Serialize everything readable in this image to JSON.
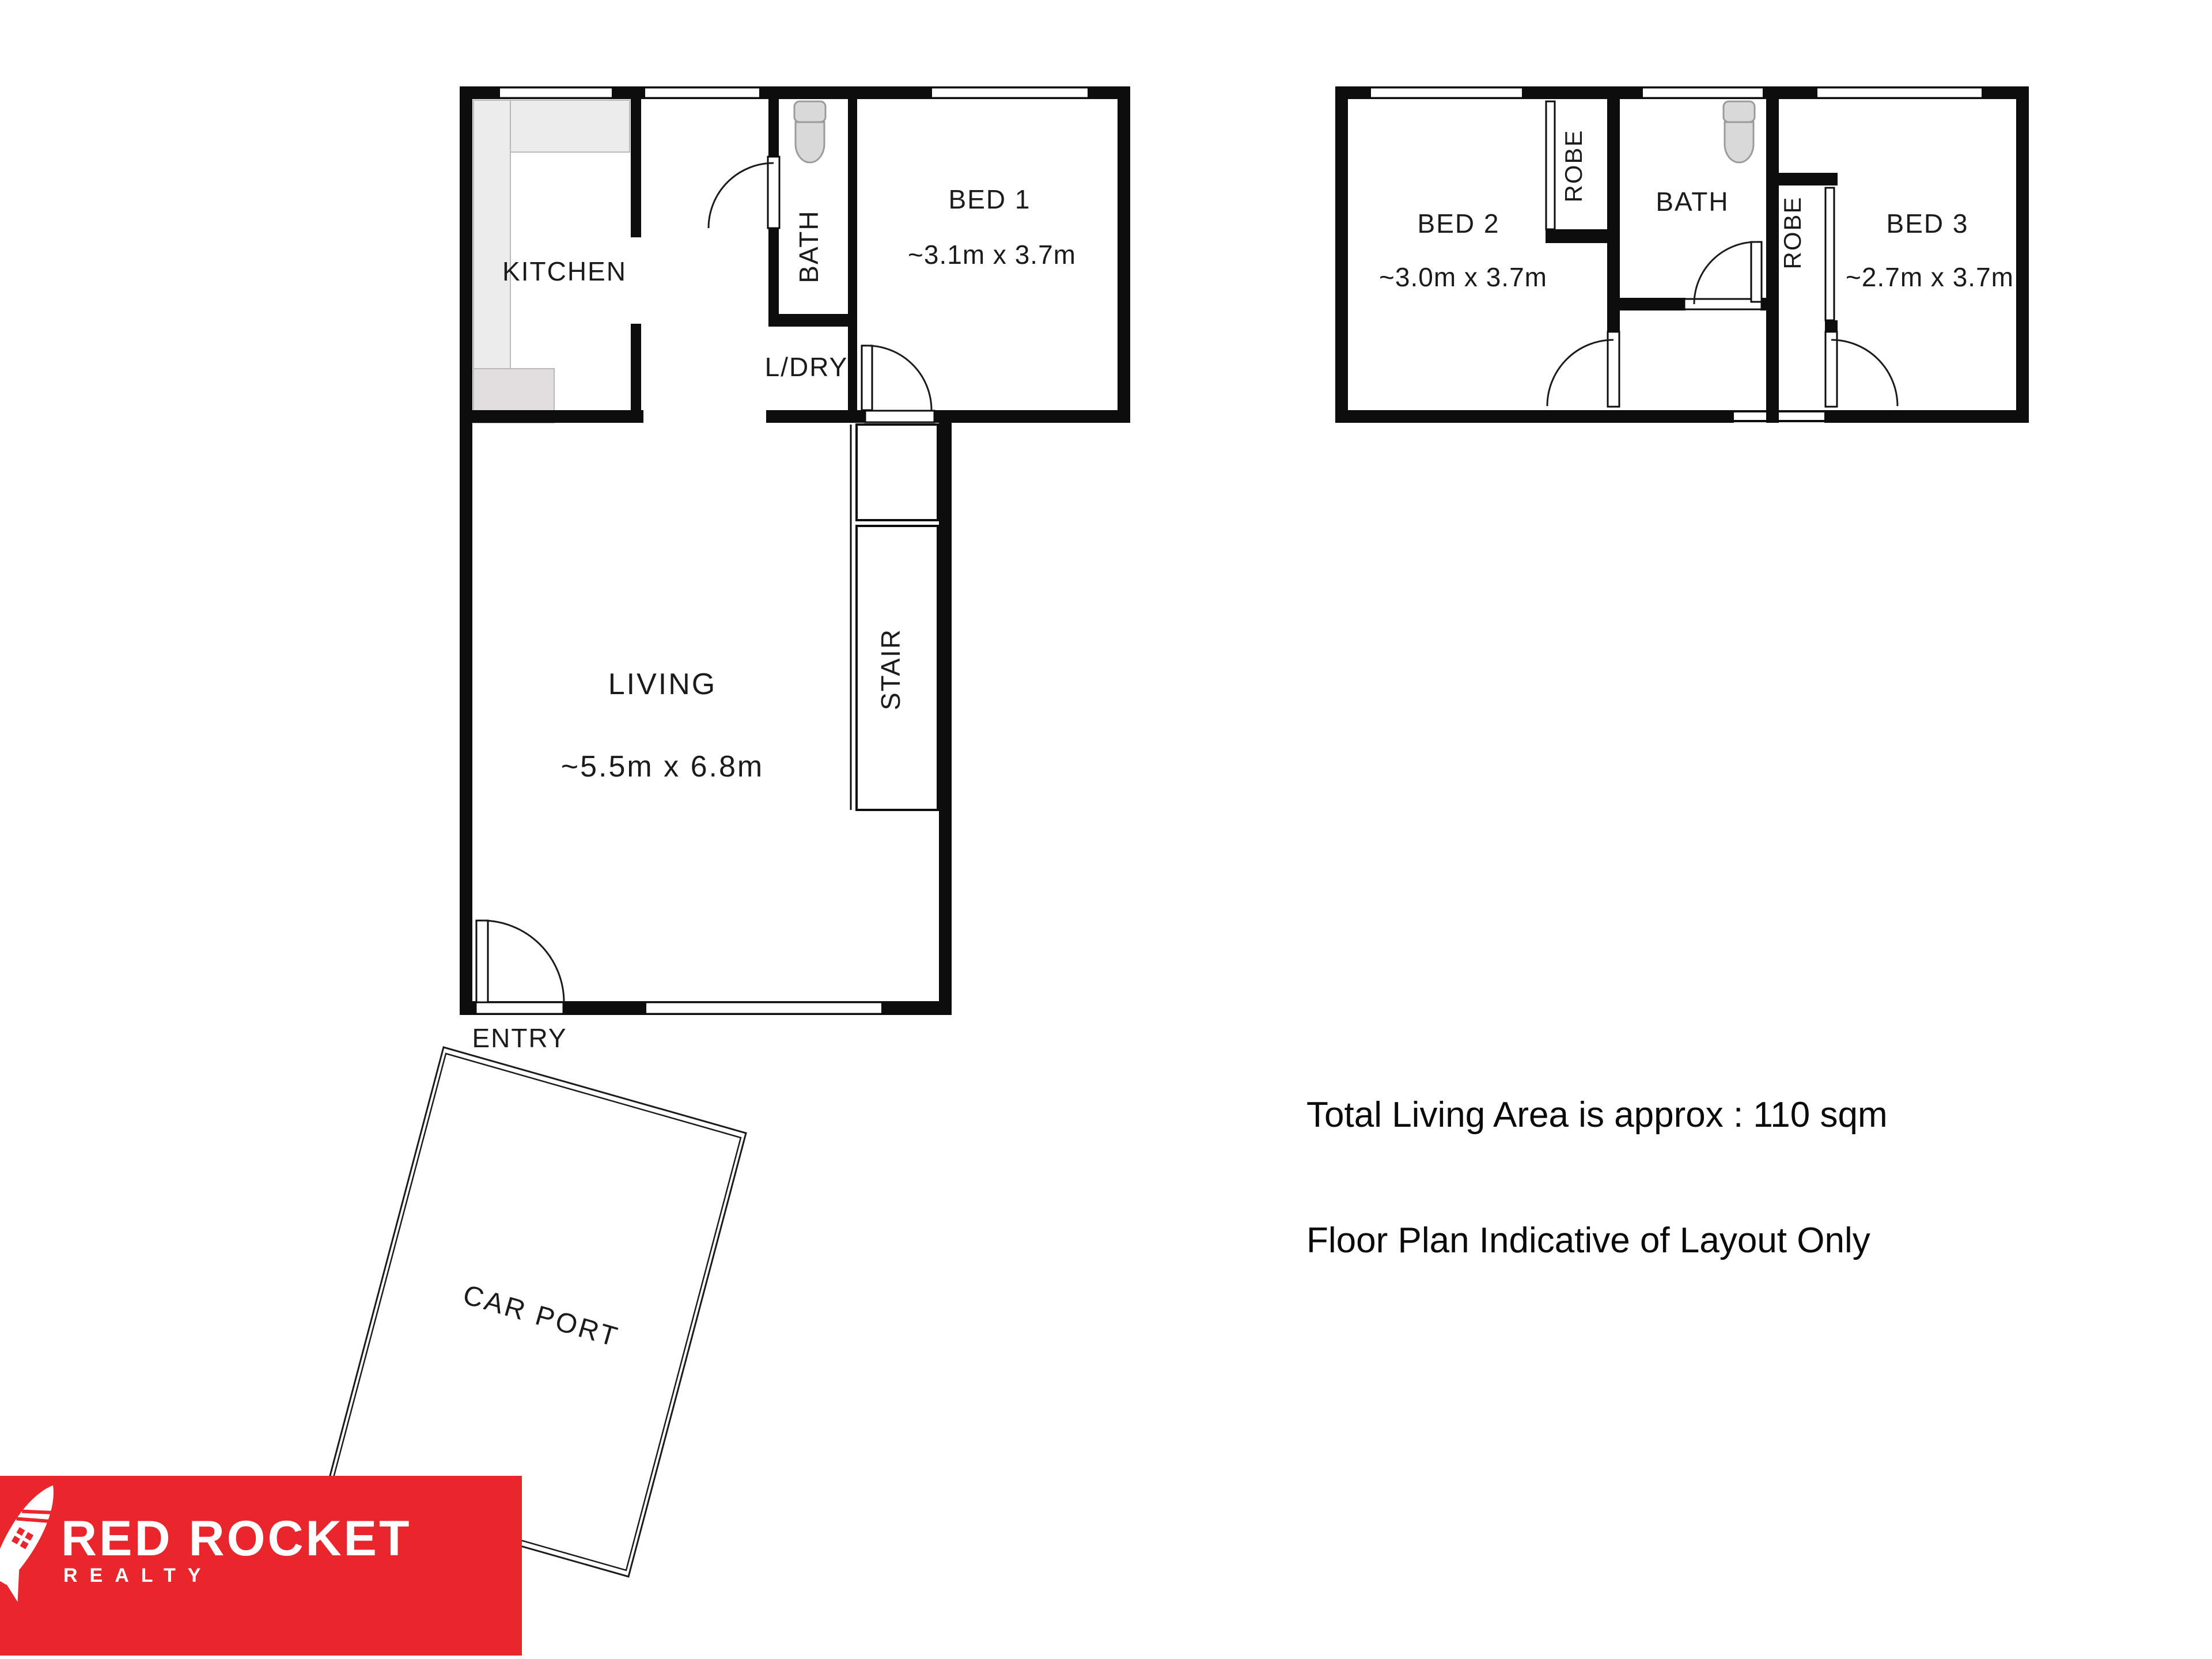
{
  "colors": {
    "background": "#ffffff",
    "wall": "#0d0d0d",
    "counter_gray": "#ececec",
    "fixture_gray": "#d9d9d9",
    "logo_red": "#e8262c",
    "logo_text": "#ffffff"
  },
  "ground_floor": {
    "kitchen_label": "KITCHEN",
    "bath_label": "BATH",
    "bed1_label": "BED 1",
    "bed1_dims": "~3.1m x 3.7m",
    "laundry_label": "L/DRY",
    "living_label": "LIVING",
    "living_dims": "~5.5m x 6.8m",
    "stair_label": "STAIR",
    "entry_label": "ENTRY",
    "carport_label": "CAR PORT"
  },
  "upper_floor": {
    "bed2_label": "BED 2",
    "bed2_dims": "~3.0m x 3.7m",
    "robe_left_label": "ROBE",
    "bath_label": "BATH",
    "robe_right_label": "ROBE",
    "bed3_label": "BED 3",
    "bed3_dims": "~2.7m x 3.7m"
  },
  "annotations": {
    "total_area": "Total Living Area is approx : 110 sqm",
    "disclaimer": "Floor Plan Indicative of Layout Only"
  },
  "logo": {
    "brand": "RED ROCKET",
    "subtitle": "REALTY"
  }
}
